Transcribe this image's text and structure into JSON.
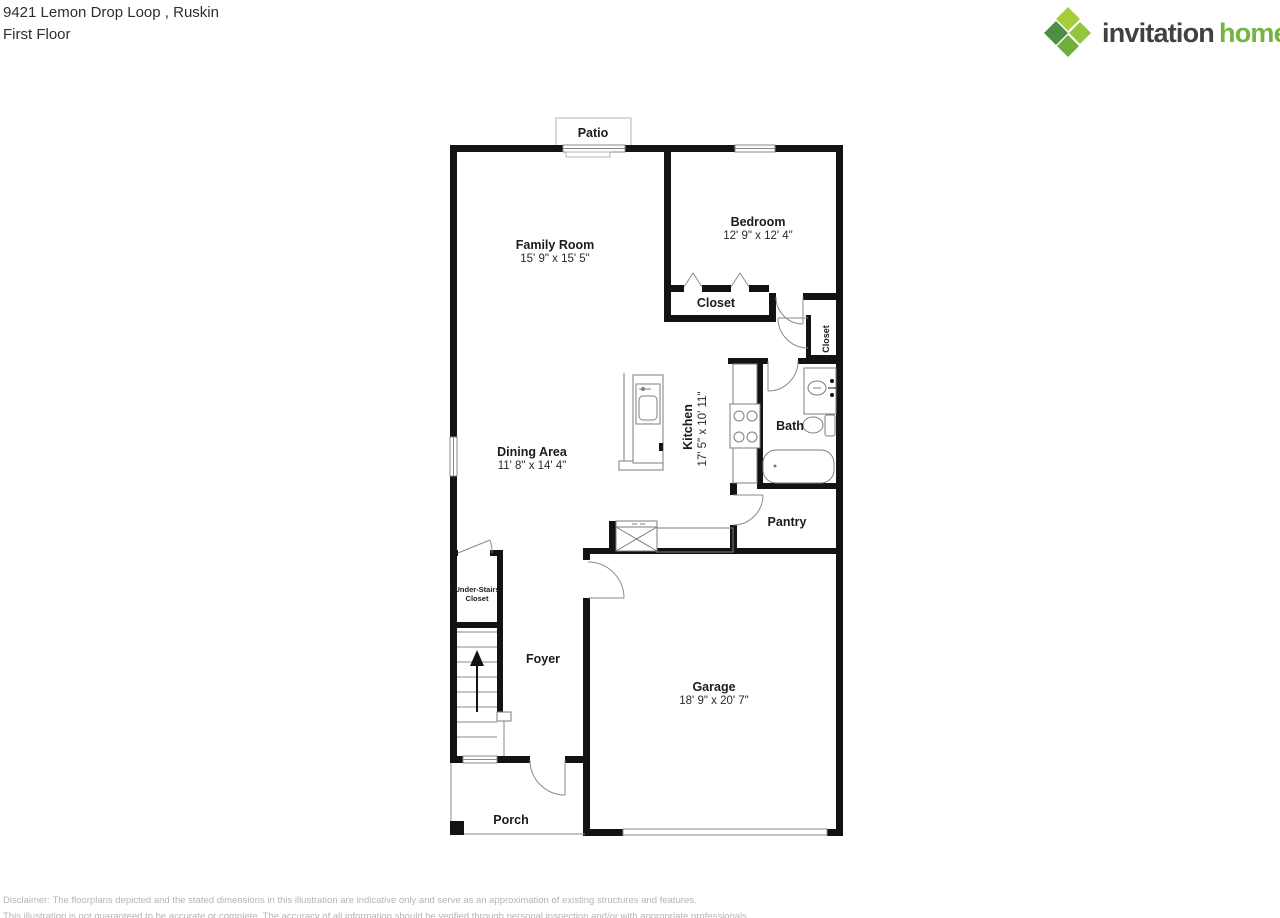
{
  "header": {
    "address": "9421 Lemon Drop Loop , Ruskin",
    "floor": "First Floor"
  },
  "logo": {
    "brand_word1": "invitation",
    "brand_word2": "homes",
    "trademark": "™",
    "colors": {
      "word1_text": "#414042",
      "word2_text": "#72b543",
      "diamond_top": "#a5cd39",
      "diamond_right": "#93c63e",
      "diamond_bottom": "#6fae3d",
      "diamond_left": "#4c8f43"
    }
  },
  "rooms": {
    "patio": {
      "label": "Patio"
    },
    "family_room": {
      "label": "Family Room",
      "dimensions": "15' 9\" x 15' 5\""
    },
    "bedroom": {
      "label": "Bedroom",
      "dimensions": "12' 9\" x 12' 4\""
    },
    "bedroom_closet": {
      "label": "Closet"
    },
    "hall_closet": {
      "label": "Closet"
    },
    "kitchen": {
      "label": "Kitchen",
      "dimensions": "17' 5\" x 10' 11\""
    },
    "bath": {
      "label": "Bath"
    },
    "dining_area": {
      "label": "Dining Area",
      "dimensions": "11' 8\" x 14' 4\""
    },
    "pantry": {
      "label": "Pantry"
    },
    "under_stairs_closet": {
      "line1": "Under-Stairs",
      "line2": "Closet"
    },
    "foyer": {
      "label": "Foyer"
    },
    "garage": {
      "label": "Garage",
      "dimensions": "18' 9\" x 20' 7\""
    },
    "porch": {
      "label": "Porch"
    }
  },
  "footer": {
    "line1": "Disclaimer: The floorplans depicted and the stated dimensions in this illustration are indicative only and serve as an approximation of existing structures and features.",
    "line2": "This illustration is not guaranteed to be accurate or complete. The accuracy of all information should be verified through personal inspection and/or with appropriate professionals."
  }
}
